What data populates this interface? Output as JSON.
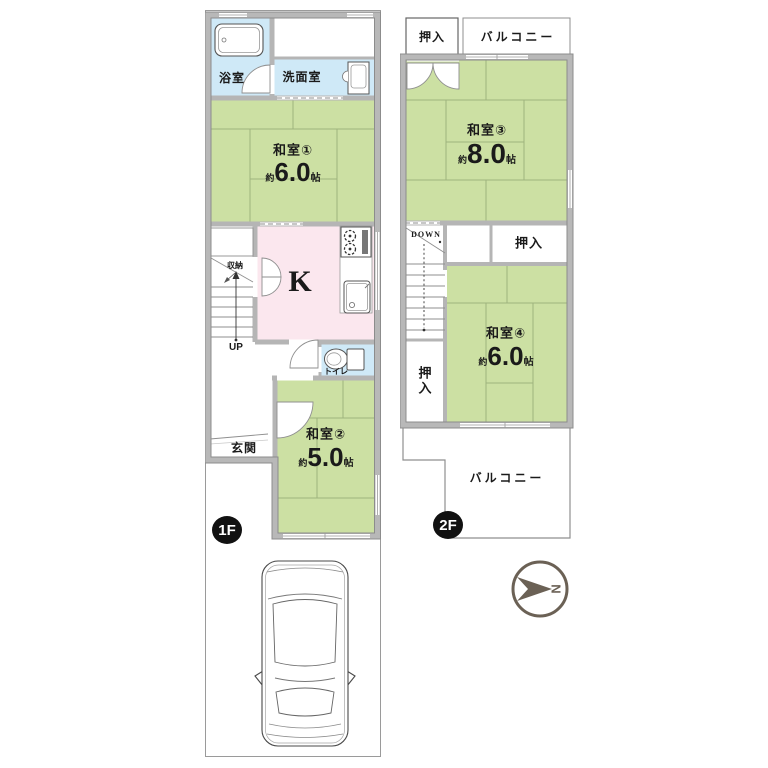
{
  "f1": {
    "badge": "1F",
    "bath": "浴室",
    "washroom": "洗面室",
    "tatami1": {
      "name": "和室①",
      "approx": "約",
      "size": "6.0",
      "unit": "帖"
    },
    "storage": "収納",
    "stairs": "UP",
    "kitchen": "K",
    "toilet": "トイレ",
    "entrance": "玄関",
    "tatami2": {
      "name": "和室②",
      "approx": "約",
      "size": "5.0",
      "unit": "帖"
    }
  },
  "f2": {
    "badge": "2F",
    "closet_top": "押入",
    "balcony_top": "バルコニー",
    "tatami3": {
      "name": "和室③",
      "approx": "約",
      "size": "8.0",
      "unit": "帖"
    },
    "stairs": "DOWN",
    "closet_mid": "押入",
    "tatami4": {
      "name": "和室④",
      "approx": "約",
      "size": "6.0",
      "unit": "帖"
    },
    "closet_left": "押入",
    "balcony_bottom": "バルコニー"
  },
  "compass": {
    "north": "N"
  },
  "colors": {
    "tatami": "#cce0a3",
    "water": "#cfe9f7",
    "kitchen": "#fbe7ee",
    "wall": "#b5b5b5",
    "accent": "#6b6155"
  }
}
